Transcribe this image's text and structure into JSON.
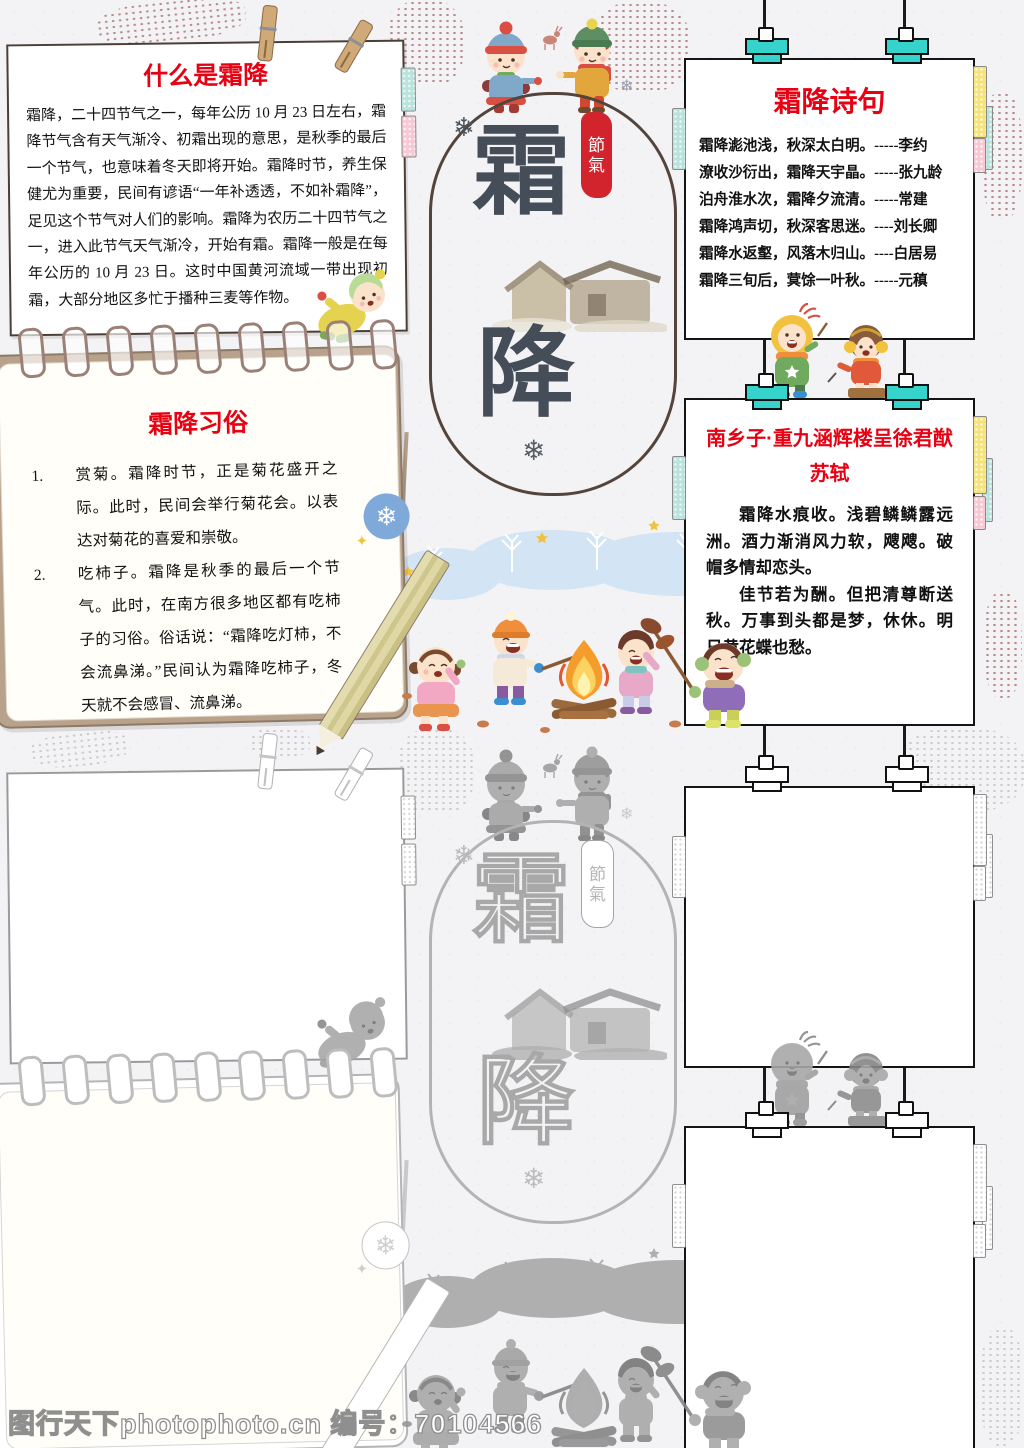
{
  "watermark": {
    "text": "图行天下photophoto.cn 编号：70104566"
  },
  "colors": {
    "accent_red": "#e60113",
    "seal_red": "#d2242c",
    "clip_teal": "#35d3cb",
    "char_slate": "#454e58"
  },
  "top": {
    "what_box": {
      "title": "什么是霜降",
      "body": "霜降，二十四节气之一，每年公历 10 月 23 日左右，霜降节气含有天气渐冷、初霜出现的意思，是秋季的最后一个节气，也意味着冬天即将开始。霜降时节，养生保健尤为重要，民间有谚语“一年补透透，不如补霜降”，足见这个节气对人们的影响。霜降为农历二十四节气之一，进入此节气天气渐冷，开始有霜。霜降一般是在每年公历的 10 月 23 日。这时中国黄河流域一带出现初霜，大部分地区多忙于播种三麦等作物。"
    },
    "customs_box": {
      "title": "霜降习俗",
      "items": [
        {
          "num": "1.",
          "text": "赏菊。霜降时节，正是菊花盛开之际。此时，民间会举行菊花会。以表达对菊花的喜爱和崇敬。"
        },
        {
          "num": "2.",
          "text": "吃柿子。霜降是秋季的最后一个节气。此时，在南方很多地区都有吃柿子的习俗。俗话说：“霜降吃灯柿，不会流鼻涕。”民间认为霜降吃柿子，冬天就不会感冒、流鼻涕。"
        }
      ]
    },
    "center": {
      "char_top": "霜",
      "char_bottom": "降",
      "seal_chars": [
        "節",
        "氣"
      ]
    },
    "poems_box": {
      "title": "霜降诗句",
      "lines": [
        "霜降滮池浅，秋深太白明。-----李约",
        "潦收沙衍出，霜降天宇晶。-----张九龄",
        "泊舟淮水次，霜降夕流清。-----常建",
        "霜降鸿声切，秋深客思迷。----刘长卿",
        "霜降水返壑，风落木归山。----白居易",
        "霜降三旬后，蓂馀一叶秋。-----元稹"
      ]
    },
    "songci_box": {
      "title": "南乡子·重九涵辉楼呈徐君猷",
      "author": "苏轼",
      "paras": [
        "霜降水痕收。浅碧鳞鳞露远洲。酒力渐消风力软，飕飕。破帽多情却恋头。",
        "佳节若为酬。但把清尊断送秋。万事到头都是梦，休休。明日黄花蝶也愁。"
      ]
    }
  },
  "bottom_outline": {
    "center": {
      "char_top": "霜",
      "char_bottom": "降",
      "seal_chars": [
        "節",
        "氣"
      ]
    }
  }
}
